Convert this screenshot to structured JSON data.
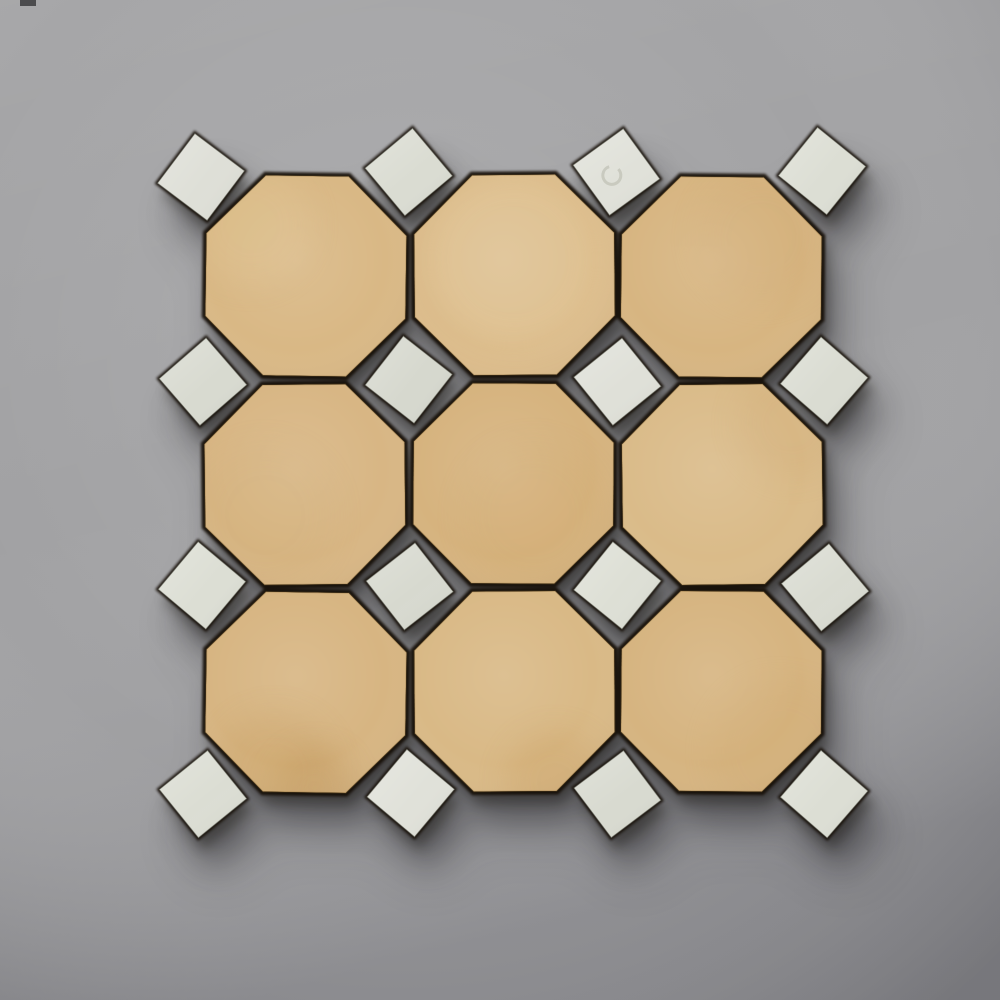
{
  "image": {
    "type": "product-photo",
    "subject": "octagon-and-dot mosaic tile panel on concrete surface",
    "width": 1000,
    "height": 1000
  },
  "background": {
    "base_color": "#a1a1a3",
    "highlight_color": "#b2b2b4",
    "edge_shade_color": "#8c8c8f",
    "artifact_mark": {
      "x": 20,
      "y": 0,
      "w": 16,
      "h": 6,
      "color": "#2e2e30",
      "opacity": 0.75
    }
  },
  "shadow_layers": [
    {
      "dx": 18,
      "dy": 42,
      "blur": 26,
      "color": "#1f1e22",
      "opacity": 0.2
    },
    {
      "dx": 13,
      "dy": 30,
      "blur": 15,
      "color": "#1f1e22",
      "opacity": 0.4
    },
    {
      "dx": 5,
      "dy": 12,
      "blur": 6,
      "color": "#17150f",
      "opacity": 0.4
    }
  ],
  "grout": {
    "color": "#171009",
    "opacity": 0.95,
    "blur": 1.2,
    "octagon_scale": 1.035,
    "dot_scale": 1.07
  },
  "panel": {
    "grid": {
      "octagon_rows": 3,
      "octagon_cols": 3,
      "dot_rows": 4,
      "dot_cols": 4,
      "origin_x": 205,
      "origin_y": 175,
      "pitch": 205.7,
      "octagon_flat": 200,
      "octagon_cut": 58.6,
      "dot_side": 62
    },
    "octagon_edge_color": "rgba(120,88,40,0.30)",
    "dot_edge_color": "rgba(130,132,120,0.55)",
    "octagons": [
      {
        "r": 0,
        "c": 0,
        "dx": -2,
        "dy": -2,
        "rot": 0.8,
        "fill": "#d9b885",
        "spots": [
          {
            "x": -55,
            "y": -50,
            "rad": 60,
            "color": "#e4c998",
            "opacity": 0.25
          }
        ]
      },
      {
        "r": 0,
        "c": 1,
        "dx": 1,
        "dy": -3,
        "rot": -0.5,
        "fill": "#dcbc8b",
        "spots": [
          {
            "x": 0,
            "y": -15,
            "rad": 85,
            "color": "#e7d0a4",
            "opacity": 0.28
          }
        ]
      },
      {
        "r": 0,
        "c": 2,
        "dx": 2,
        "dy": -1,
        "rot": 0.6,
        "fill": "#d7b581",
        "spots": [
          {
            "x": 40,
            "y": -40,
            "rad": 65,
            "color": "#cfa873",
            "opacity": 0.22
          }
        ]
      },
      {
        "r": 1,
        "c": 0,
        "dx": -3,
        "dy": 1,
        "rot": -0.6,
        "fill": "#d8b684",
        "spots": [
          {
            "x": -40,
            "y": 30,
            "rad": 70,
            "color": "#cfad76",
            "opacity": 0.2
          }
        ]
      },
      {
        "r": 1,
        "c": 1,
        "dx": 0,
        "dy": 0,
        "rot": 0.4,
        "fill": "#d6b37e",
        "spots": [
          {
            "x": 20,
            "y": 30,
            "rad": 70,
            "color": "#cfa96f",
            "opacity": 0.22
          }
        ]
      },
      {
        "r": 1,
        "c": 2,
        "dx": 3,
        "dy": 1,
        "rot": -0.7,
        "fill": "#dabb89",
        "spots": [
          {
            "x": 70,
            "y": -60,
            "rad": 55,
            "color": "#cfa873",
            "opacity": 0.22
          }
        ]
      },
      {
        "r": 2,
        "c": 0,
        "dx": -2,
        "dy": 3,
        "rot": 0.9,
        "fill": "#d7b582",
        "spots": [
          {
            "x": -30,
            "y": 80,
            "rad": 60,
            "color": "#c79e62",
            "opacity": 0.3
          },
          {
            "x": 10,
            "y": 95,
            "rad": 40,
            "color": "#b98e52",
            "opacity": 0.25
          }
        ]
      },
      {
        "r": 2,
        "c": 1,
        "dx": 1,
        "dy": 2,
        "rot": -0.4,
        "fill": "#d9b986",
        "spots": [
          {
            "x": 40,
            "y": 90,
            "rad": 50,
            "color": "#c89c5e",
            "opacity": 0.28
          }
        ]
      },
      {
        "r": 2,
        "c": 2,
        "dx": 2,
        "dy": 2,
        "rot": 0.5,
        "fill": "#d6b480",
        "spots": [
          {
            "x": 60,
            "y": 60,
            "rad": 70,
            "color": "#cda66c",
            "opacity": 0.2
          }
        ]
      }
    ],
    "dots": [
      {
        "r": 0,
        "c": 0,
        "dx": -4,
        "dy": 2,
        "rot": -8,
        "fill": "#dedfd7",
        "stamp": false
      },
      {
        "r": 0,
        "c": 1,
        "dx": -2,
        "dy": -3,
        "rot": 5,
        "fill": "#dadcd2",
        "stamp": false
      },
      {
        "r": 0,
        "c": 2,
        "dx": 0,
        "dy": -3,
        "rot": 9,
        "fill": "#e0e1d9",
        "stamp": true
      },
      {
        "r": 0,
        "c": 3,
        "dx": 0,
        "dy": -4,
        "rot": -6,
        "fill": "#dcded4",
        "stamp": false
      },
      {
        "r": 1,
        "c": 0,
        "dx": -2,
        "dy": 1,
        "rot": 4,
        "fill": "#d8dad0",
        "stamp": false
      },
      {
        "r": 1,
        "c": 1,
        "dx": -2,
        "dy": -1,
        "rot": -7,
        "fill": "#d6d8ce",
        "stamp": false
      },
      {
        "r": 1,
        "c": 2,
        "dx": 1,
        "dy": 1,
        "rot": 6,
        "fill": "#dfe0d8",
        "stamp": false
      },
      {
        "r": 1,
        "c": 3,
        "dx": 2,
        "dy": 0,
        "rot": -4,
        "fill": "#dadcd2",
        "stamp": false
      },
      {
        "r": 2,
        "c": 0,
        "dx": -3,
        "dy": -1,
        "rot": -5,
        "fill": "#dcded4",
        "stamp": false
      },
      {
        "r": 2,
        "c": 1,
        "dx": -1,
        "dy": 0,
        "rot": 7,
        "fill": "#d7d9cf",
        "stamp": false
      },
      {
        "r": 2,
        "c": 2,
        "dx": 1,
        "dy": -1,
        "rot": -6,
        "fill": "#dddfd5",
        "stamp": false
      },
      {
        "r": 2,
        "c": 3,
        "dx": 3,
        "dy": 1,
        "rot": 5,
        "fill": "#d9dbd1",
        "stamp": false
      },
      {
        "r": 3,
        "c": 0,
        "dx": -2,
        "dy": 2,
        "rot": 6,
        "fill": "#dbddd3",
        "stamp": false
      },
      {
        "r": 3,
        "c": 1,
        "dx": 0,
        "dy": 1,
        "rot": -5,
        "fill": "#e0e1d9",
        "stamp": false
      },
      {
        "r": 3,
        "c": 2,
        "dx": 1,
        "dy": 2,
        "rot": 8,
        "fill": "#d8dad0",
        "stamp": false
      },
      {
        "r": 3,
        "c": 3,
        "dx": 2,
        "dy": 2,
        "rot": -4,
        "fill": "#dcded4",
        "stamp": false
      }
    ],
    "stamp_mark": {
      "radius": 9,
      "color": "#b9bbae",
      "opacity": 0.6,
      "stroke_width": 3
    }
  }
}
